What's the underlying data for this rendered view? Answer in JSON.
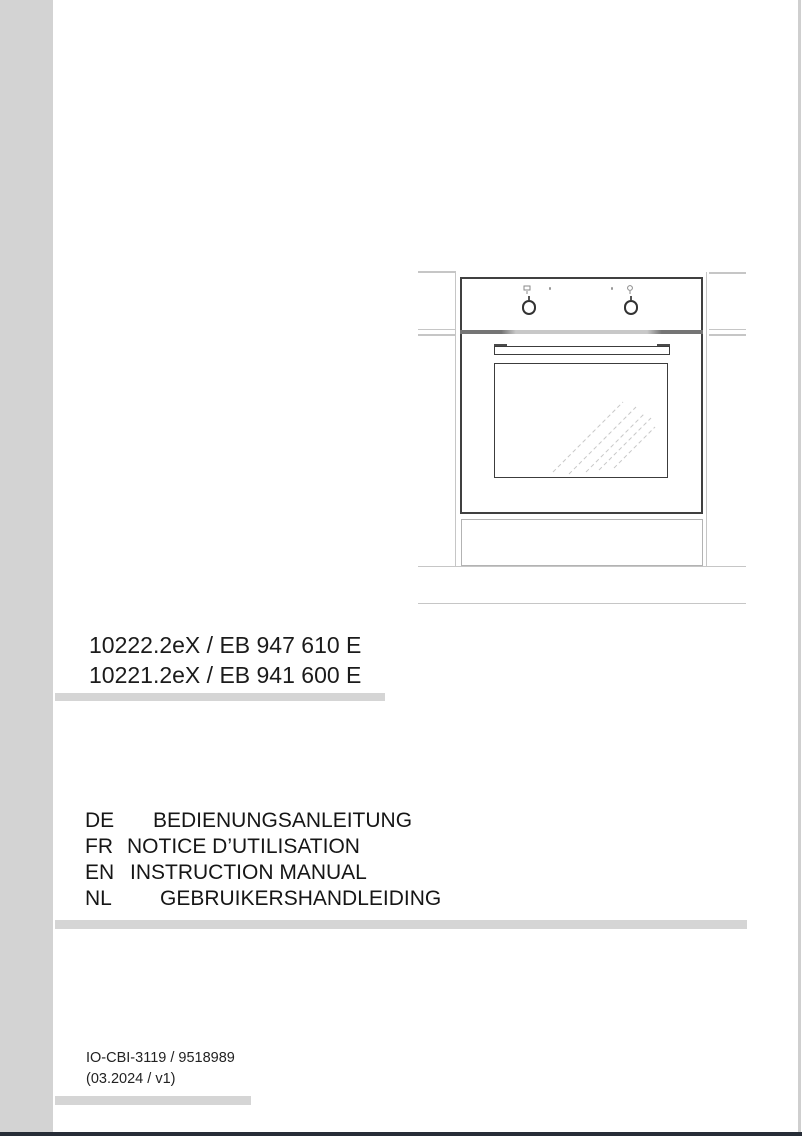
{
  "document": {
    "models": [
      "10222.2eX / EB 947 610 E",
      "10221.2eX / EB 941 600 E"
    ],
    "languages": [
      {
        "code": "DE",
        "title": "BEDIENUNGSANLEITUNG"
      },
      {
        "code": "FR",
        "title": "NOTICE D’UTILISATION"
      },
      {
        "code": "EN",
        "title": "INSTRUCTION MANUAL"
      },
      {
        "code": "NL",
        "title": "GEBRUIKERSHANDLEIDING"
      }
    ],
    "footer": {
      "doc_code": "IO-CBI-3119 / 9518989",
      "revision": "(03.2024 / v1)"
    },
    "illustration_description": "built-in oven line drawing with two control knobs, handle, glass door and cabinet outlines"
  },
  "colors": {
    "page_bg": "#ffffff",
    "scan_margin_strip": "#d3d3d3",
    "divider_bar": "#d5d5d5",
    "bottom_edge_strip": "#272d37",
    "line_art_dark": "#404040",
    "line_art_light": "#c6c6c6",
    "text": "#1b1b1b"
  }
}
